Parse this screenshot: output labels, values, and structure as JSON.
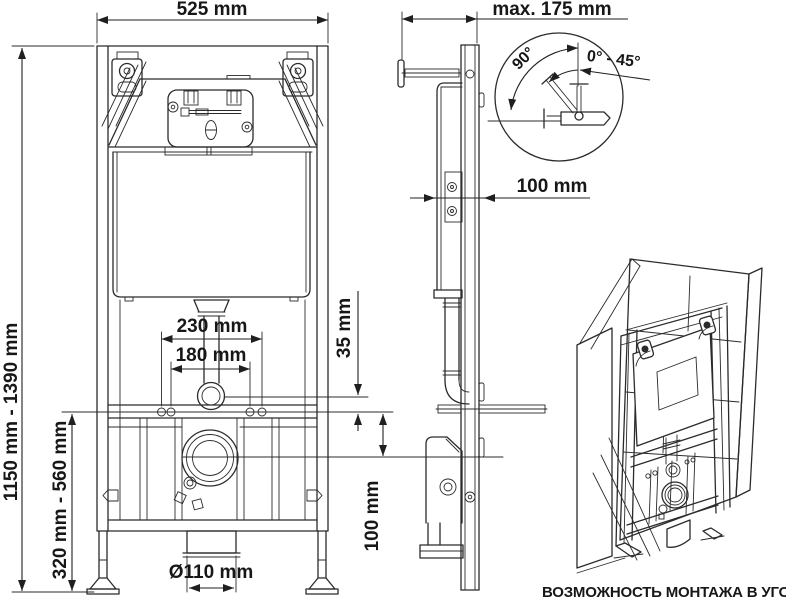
{
  "style": {
    "line_color": "#2b2b2b",
    "text_color": "#171717",
    "background": "#ffffff"
  },
  "labels": {
    "width_top": "525 mm",
    "depth_top": "max. 175 mm",
    "height_range": "1150 mm - 1390 mm",
    "flush_width": "230 mm",
    "fix_width": "180 mm",
    "offset_small": "35 mm",
    "lower_range": "320 mm - 560 mm",
    "drain_offset": "100 mm",
    "wall_gap": "100 mm",
    "drain_diameter": "Ø110 mm",
    "angle_left": "90°",
    "angle_range": "0° - 45°",
    "caption": "ВОЗМОЖНОСТЬ МОНТАЖА В УГОЛ"
  }
}
